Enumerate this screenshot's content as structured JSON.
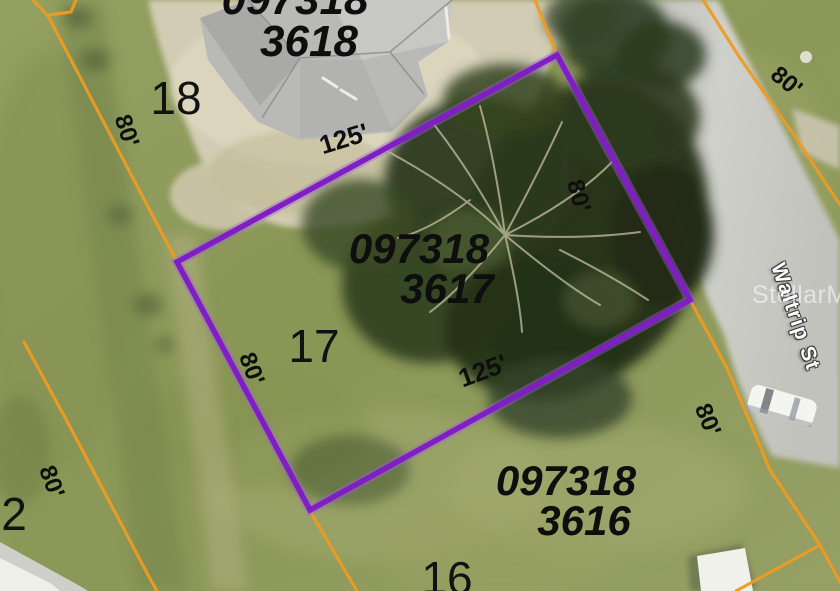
{
  "map": {
    "street": {
      "name": "Waltrip St"
    },
    "watermark": "StellarMLS",
    "colors": {
      "parcel_boundary": "#ee9b23",
      "highlight_outline": "#7e1ec4",
      "road": "#c7c7c3",
      "label_text": "#0e0e0e"
    },
    "parcels": [
      {
        "name": "parcel-3618",
        "apn_line1": "097318",
        "apn_line2": "3618",
        "lot": "18"
      },
      {
        "name": "parcel-3617",
        "apn_line1": "097318",
        "apn_line2": "3617",
        "lot": "17",
        "highlighted": true
      },
      {
        "name": "parcel-3616",
        "apn_line1": "097318",
        "apn_line2": "3616",
        "lot": "16"
      },
      {
        "name": "parcel-lot-2",
        "lot": "2"
      }
    ],
    "dimensions": [
      {
        "id": "lot18-west-frontage",
        "text": "80'"
      },
      {
        "id": "lot17-north-depth",
        "text": "125'"
      },
      {
        "id": "lot17-northeast-frontage",
        "text": "80'"
      },
      {
        "id": "lot17-west-frontage",
        "text": "80'"
      },
      {
        "id": "lot17-south-depth",
        "text": "125'"
      },
      {
        "id": "lot2-east-frontage",
        "text": "80'"
      },
      {
        "id": "across-street-frontage",
        "text": "80'"
      },
      {
        "id": "lot16-east-frontage",
        "text": "80'"
      }
    ]
  }
}
